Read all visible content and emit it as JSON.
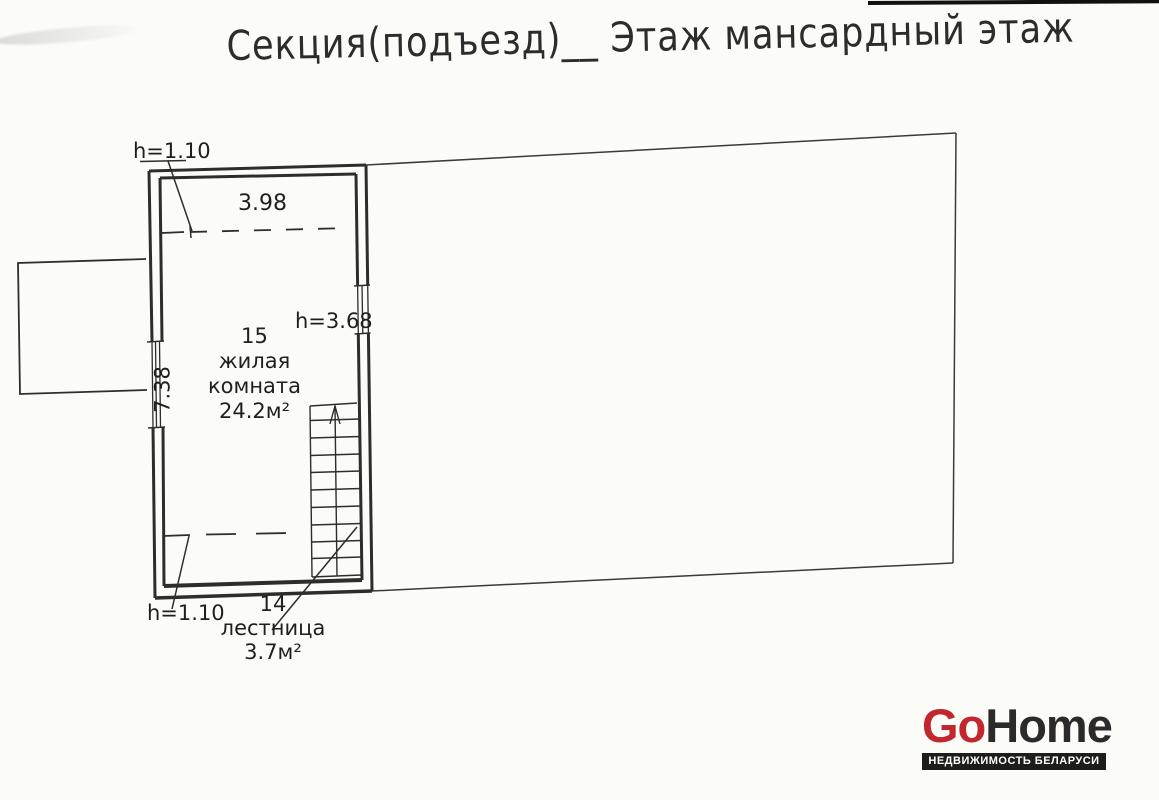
{
  "title": "Секция(подъезд)__ Этаж мансардный этаж",
  "plan": {
    "room": {
      "number": "15",
      "name_line1": "жилая",
      "name_line2": "комната",
      "area": "24.2м²"
    },
    "stairs": {
      "number": "14",
      "name": "лестница",
      "area": "3.7м²"
    },
    "dimensions": {
      "width_at_break_line": "3.98",
      "room_depth": "7.38",
      "height_top_left": "h=1.10",
      "height_right": "h=3.68",
      "height_bottom_left": "h=1.10"
    }
  },
  "logo": {
    "name_part1": "Go",
    "name_part2": "Home",
    "tagline": "НЕДВИЖИМОСТЬ БЕЛАРУСИ",
    "accent_color": "#c1272d",
    "text_color": "#2d2a2b",
    "bar_color": "#1d1d1b"
  },
  "colors": {
    "paper": "#fbfbf8",
    "ink": "#2d2d2d"
  }
}
